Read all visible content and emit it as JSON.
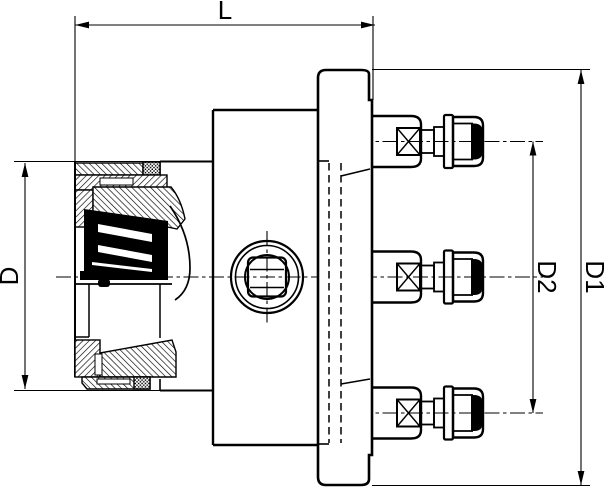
{
  "drawing": {
    "labels": {
      "length": "L",
      "outer_diameter": "D",
      "flange_diameter": "D1",
      "bolt_circle_diameter": "D2"
    },
    "colors": {
      "line": "#000000",
      "background": "#ffffff"
    }
  }
}
